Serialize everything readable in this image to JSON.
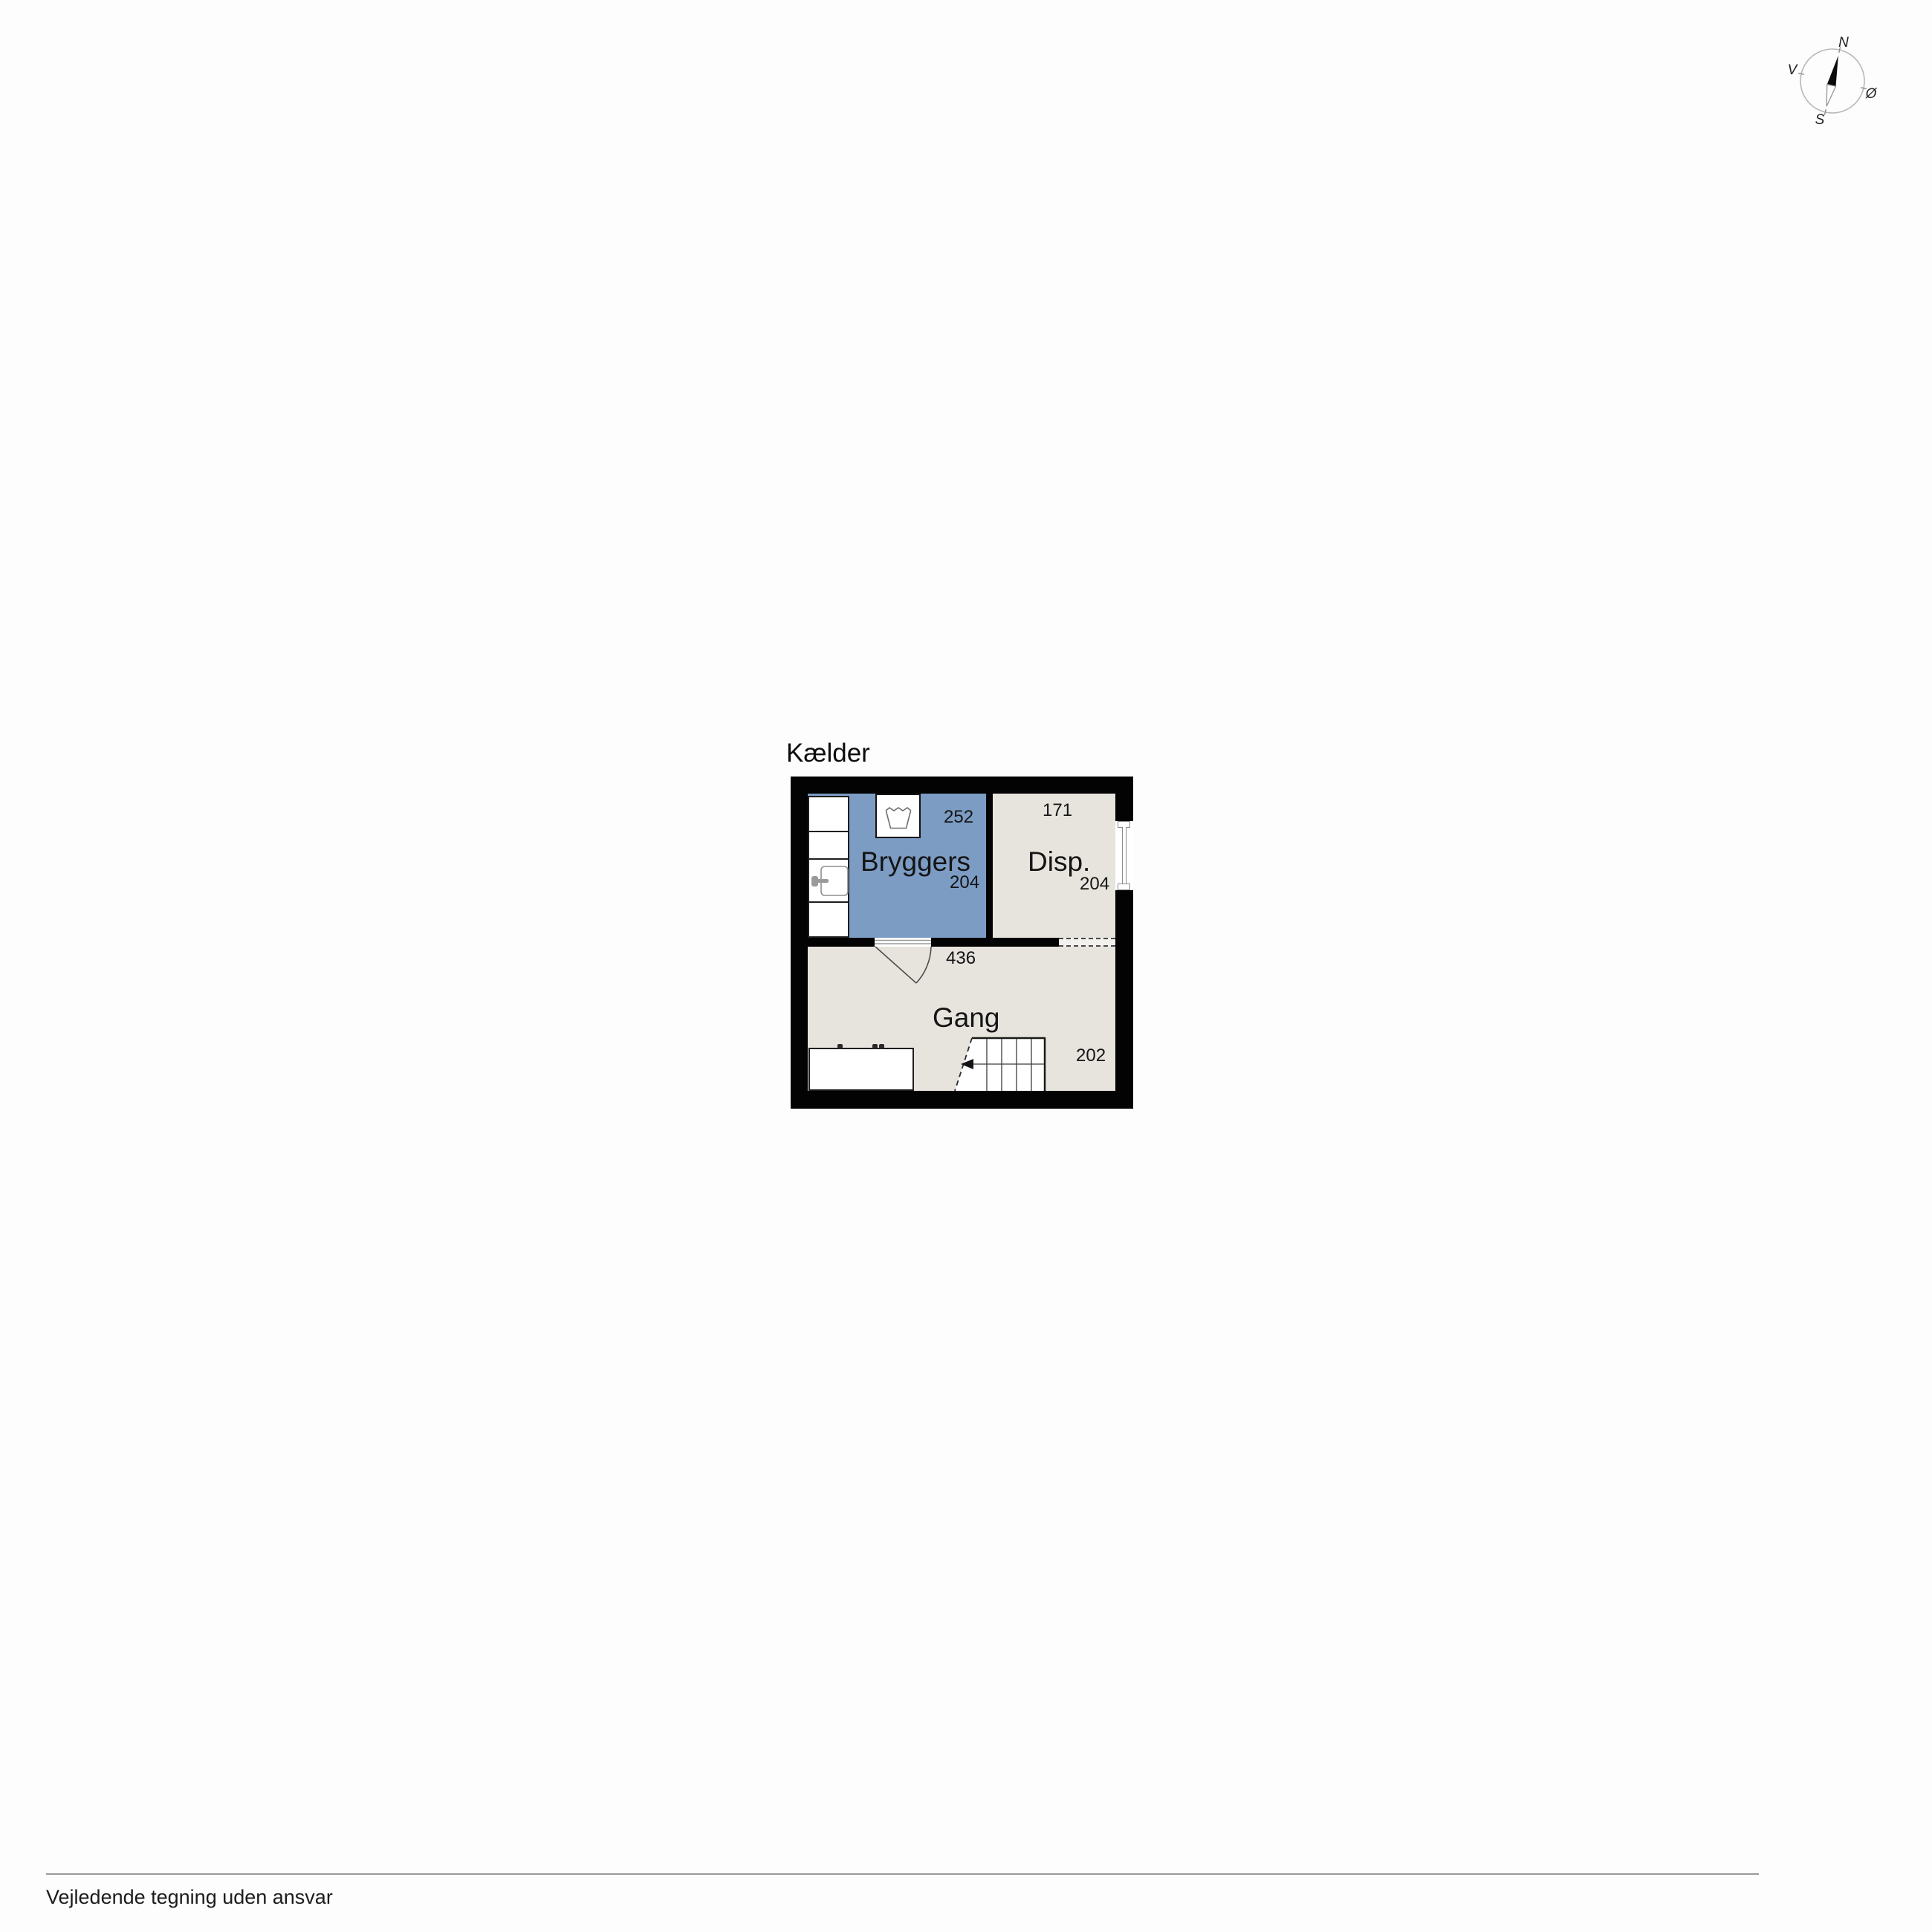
{
  "page": {
    "footer_disclaimer": "Vejledende tegning uden ansvar"
  },
  "floorplan": {
    "floor_label": "Kælder",
    "wall_color": "#030303",
    "rooms": [
      {
        "name": "Bryggers",
        "width_cm": "252",
        "depth_cm": "204",
        "fill": "#7c9cc4"
      },
      {
        "name": "Disp.",
        "width_cm": "171",
        "depth_cm": "204",
        "fill": "#e7e3dd"
      },
      {
        "name": "Gang",
        "width_cm": "436",
        "depth_cm": "202",
        "fill": "#e7e3dd"
      }
    ],
    "fixtures": [
      "washing-machine-icon",
      "sink-icon",
      "counter-units",
      "interior-door-swing",
      "dashed-opening",
      "basement-window",
      "staircase-with-down-arrow",
      "workbench"
    ]
  },
  "compass": {
    "n": "N",
    "s": "S",
    "e": "Ø",
    "w": "V"
  }
}
